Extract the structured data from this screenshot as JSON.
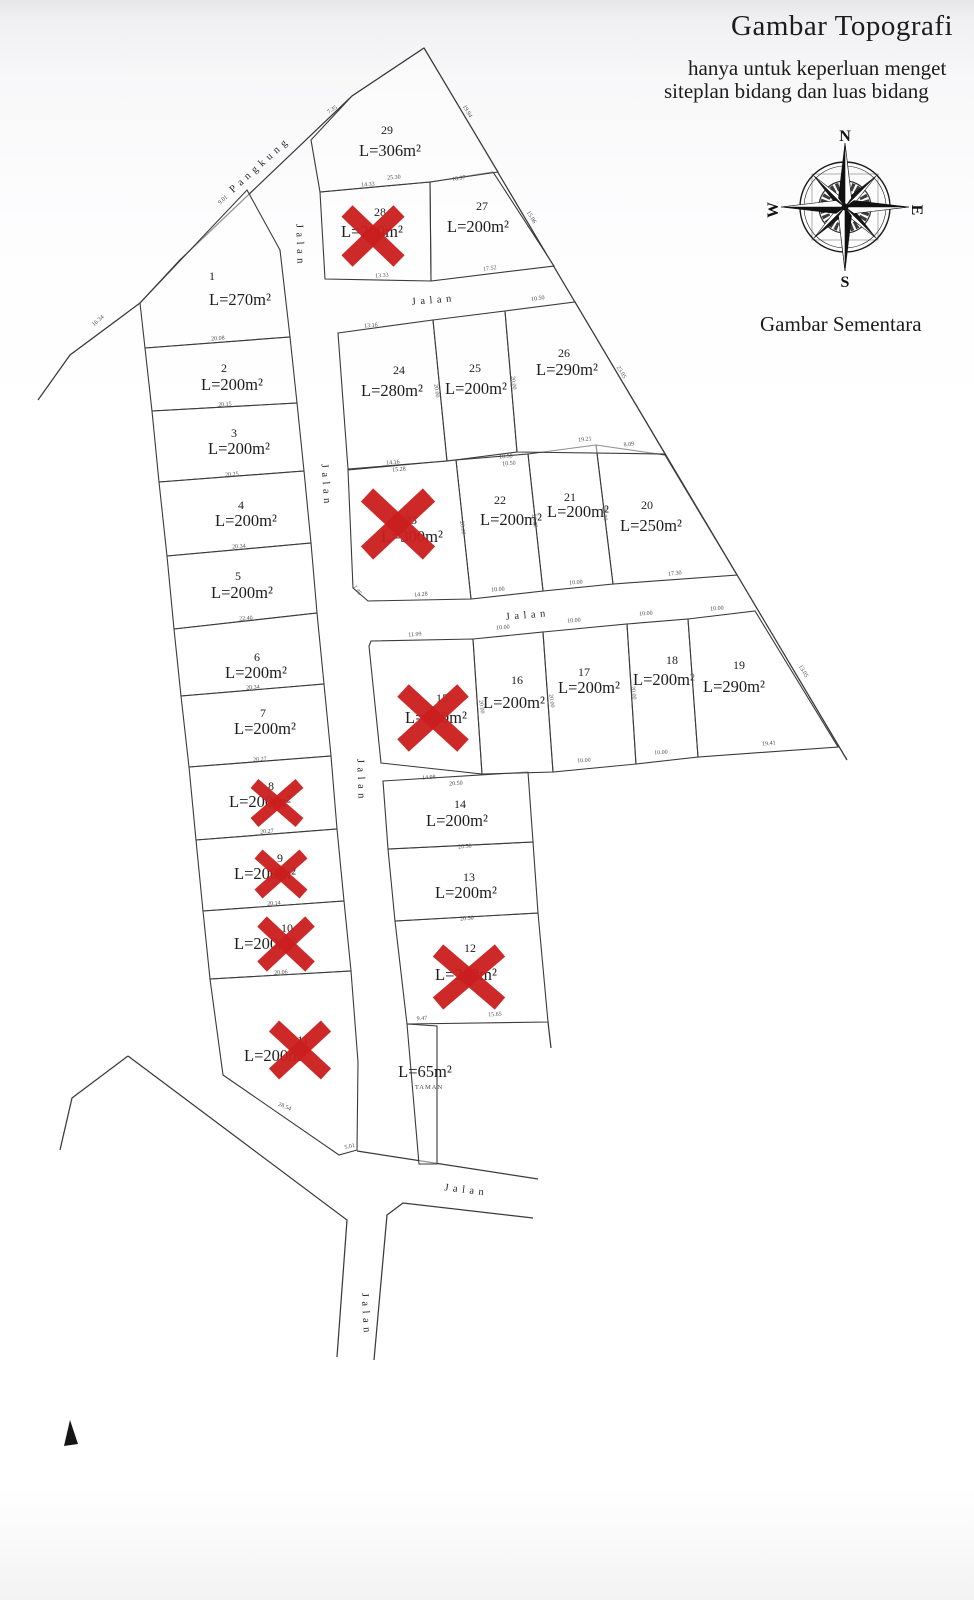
{
  "header": {
    "title": "Gambar Topografi",
    "subtitle_line1": "hanya untuk keperluan menget",
    "subtitle_line2": "siteplan bidang dan luas bidang",
    "note": "Gambar Sementara"
  },
  "compass": {
    "n": "N",
    "e": "E",
    "s": "S",
    "w": "W"
  },
  "colors": {
    "line": "#3a3a3a",
    "text": "#1c1c1c",
    "dim": "#4f4f4f",
    "road": "#272727",
    "x_mark": "#cb1e1e"
  },
  "map": {
    "outlines": [
      {
        "name": "pangkung-boundary",
        "pts": "424,48 352,96 180,260 140,303 70,355 38,400"
      },
      {
        "name": "east-boundary",
        "pts": "424,48 847,760"
      },
      {
        "name": "road-edge-southwest",
        "pts": "128,1056 347,1220 337,1357"
      },
      {
        "name": "road-edge-left-tail",
        "pts": "60,1150 72,1098 128,1056"
      },
      {
        "name": "road-edge-top",
        "pts": "357,1151 538,1179"
      },
      {
        "name": "road-edge-bottom",
        "pts": "533,1218 403,1203 387,1215 374,1360"
      },
      {
        "name": "boundary-tick",
        "pts": "548,1022 551,1048"
      },
      {
        "name": "corner-wedge",
        "pts": "70,1420 78,1444 64,1446",
        "fill": "#151515"
      }
    ],
    "plots": [
      {
        "id": "1",
        "number": "1",
        "area_label": "L=270m²",
        "poly": "247,190 280,250 290,337 145,348 140,303",
        "num": [
          212,
          280
        ],
        "area": [
          240,
          305
        ],
        "sold": false
      },
      {
        "id": "2",
        "number": "2",
        "area_label": "L=200m²",
        "poly": "145,348 290,337 297,403 152,411",
        "num": [
          224,
          372
        ],
        "area": [
          232,
          390
        ],
        "sold": false
      },
      {
        "id": "3",
        "number": "3",
        "area_label": "L=200m²",
        "poly": "152,411 297,403 304,471 159,482",
        "num": [
          234,
          437
        ],
        "area": [
          239,
          454
        ],
        "sold": false
      },
      {
        "id": "4",
        "number": "4",
        "area_label": "L=200m²",
        "poly": "159,482 304,471 311,543 167,556",
        "num": [
          241,
          509
        ],
        "area": [
          246,
          526
        ],
        "sold": false
      },
      {
        "id": "5",
        "number": "5",
        "area_label": "L=200m²",
        "poly": "167,556 311,543 317,613 174,629",
        "num": [
          238,
          580
        ],
        "area": [
          242,
          598
        ],
        "sold": false
      },
      {
        "id": "6",
        "number": "6",
        "area_label": "L=200m²",
        "poly": "174,629 317,613 324,684 181,696",
        "num": [
          257,
          661
        ],
        "area": [
          256,
          678
        ],
        "sold": false
      },
      {
        "id": "7",
        "number": "7",
        "area_label": "L=200m²",
        "poly": "181,696 324,684 331,756 189,767",
        "num": [
          263,
          717
        ],
        "area": [
          265,
          734
        ],
        "sold": false
      },
      {
        "id": "8",
        "number": "8",
        "area_label": "L=200m²",
        "poly": "189,767 331,756 337,829 196,840",
        "num": [
          271,
          790
        ],
        "area": [
          260,
          807
        ],
        "sold": true
      },
      {
        "id": "9",
        "number": "9",
        "area_label": "L=200m²",
        "poly": "196,840 337,829 344,901 203,911",
        "num": [
          280,
          862
        ],
        "area": [
          265,
          879
        ],
        "sold": true
      },
      {
        "id": "10",
        "number": "10",
        "area_label": "L=200m²",
        "poly": "203,911 344,901 351,971 210,979",
        "num": [
          287,
          932
        ],
        "area": [
          265,
          949
        ],
        "sold": true
      },
      {
        "id": "11",
        "number": "11",
        "area_label": "L=200m²",
        "poly": "210,979 351,971 358,1062 357,1150 339,1155 223,1075",
        "num": [
          303,
          1044
        ],
        "area": [
          275,
          1061
        ],
        "sold": true
      },
      {
        "id": "12",
        "number": "12",
        "area_label": "L=200m²",
        "poly": "395,921 538,913 548,1022 407,1024",
        "num": [
          470,
          952
        ],
        "area": [
          466,
          980
        ],
        "sold": true
      },
      {
        "id": "13",
        "number": "13",
        "area_label": "L=200m²",
        "poly": "388,849 533,842 538,913 395,921",
        "num": [
          469,
          881
        ],
        "area": [
          466,
          898
        ],
        "sold": false
      },
      {
        "id": "14",
        "number": "14",
        "area_label": "L=200m²",
        "poly": "383,781 528,772 533,842 388,849",
        "num": [
          460,
          808
        ],
        "area": [
          457,
          826
        ],
        "sold": false
      },
      {
        "id": "15",
        "number": "15",
        "area_label": "L=200m²",
        "poly": "369,646 371,641 473,639 482,774 381,763",
        "num": [
          442,
          702
        ],
        "area": [
          436,
          723
        ],
        "sold": true
      },
      {
        "id": "16",
        "number": "16",
        "area_label": "L=200m²",
        "poly": "473,639 543,632 553,772 482,774",
        "num": [
          517,
          684
        ],
        "area": [
          514,
          708
        ],
        "sold": false
      },
      {
        "id": "17",
        "number": "17",
        "area_label": "L=200m²",
        "poly": "543,632 627,624 636,764 553,772",
        "num": [
          584,
          676
        ],
        "area": [
          589,
          693
        ],
        "sold": false
      },
      {
        "id": "18",
        "number": "18",
        "area_label": "L=200m²",
        "poly": "627,624 688,619 698,757 636,764",
        "num": [
          672,
          664
        ],
        "area": [
          664,
          685
        ],
        "sold": false
      },
      {
        "id": "19",
        "number": "19",
        "area_label": "L=290m²",
        "poly": "688,619 755,611 838,747 698,757",
        "num": [
          739,
          669
        ],
        "area": [
          734,
          692
        ],
        "sold": false
      },
      {
        "id": "20",
        "number": "20",
        "area_label": "L=250m²",
        "poly": "596,445 665,455 737,575 613,584",
        "num": [
          647,
          509
        ],
        "area": [
          651,
          531
        ],
        "sold": false
      },
      {
        "id": "21",
        "number": "21",
        "area_label": "L=200m²",
        "poly": "528,454 596,445 613,584 543,591",
        "num": [
          570,
          501
        ],
        "area": [
          578,
          517
        ],
        "sold": false
      },
      {
        "id": "22",
        "number": "22",
        "area_label": "L=200m²",
        "poly": "456,460 528,454 543,591 471,599",
        "num": [
          500,
          504
        ],
        "area": [
          511,
          525
        ],
        "sold": false
      },
      {
        "id": "23",
        "number": "23",
        "area_label": "L=300m²",
        "poly": "348,470 456,460 471,599 368,601 353,588",
        "num": [
          411,
          524
        ],
        "area": [
          412,
          542
        ],
        "sold": true
      },
      {
        "id": "24",
        "number": "24",
        "area_label": "L=280m²",
        "poly": "338,333 433,320 447,461 348,469",
        "num": [
          399,
          374
        ],
        "area": [
          392,
          396
        ],
        "sold": false
      },
      {
        "id": "25",
        "number": "25",
        "area_label": "L=200m²",
        "poly": "433,320 505,311 517,452 447,461",
        "num": [
          475,
          372
        ],
        "area": [
          476,
          394
        ],
        "sold": false
      },
      {
        "id": "26",
        "number": "26",
        "area_label": "L=290m²",
        "poly": "505,311 575,302 665,454 517,452",
        "num": [
          564,
          357
        ],
        "area": [
          567,
          375
        ],
        "sold": false
      },
      {
        "id": "27",
        "number": "27",
        "area_label": "L=200m²",
        "poly": "430,182 493,172 554,266 431,281",
        "num": [
          482,
          210
        ],
        "area": [
          478,
          232
        ],
        "sold": false
      },
      {
        "id": "28",
        "number": "28",
        "area_label": "L=200m²",
        "poly": "320,192 430,182 431,281 325,279",
        "num": [
          380,
          216
        ],
        "area": [
          372,
          237
        ],
        "sold": true
      },
      {
        "id": "29",
        "number": "29",
        "area_label": "L=306m²",
        "poly": "352,96 424,48 498,172 430,182 320,192 311,140",
        "num": [
          387,
          134
        ],
        "area": [
          390,
          156
        ],
        "sold": false
      },
      {
        "id": "taman",
        "number": "",
        "area_label": "L=65m²",
        "poly": "407,1024 437,1026 437,1164 419,1164",
        "num": [
          0,
          0
        ],
        "area": [
          425,
          1077
        ],
        "sub": "TAMAN",
        "sub_pos": [
          429,
          1089
        ],
        "sold": false
      }
    ],
    "road_labels": [
      {
        "text": "Pangkung",
        "x": 262,
        "y": 167,
        "rot": -42
      },
      {
        "text": "Jalan",
        "x": 297,
        "y": 246,
        "rot": 88
      },
      {
        "text": "Jalan",
        "x": 434,
        "y": 303,
        "rot": -5
      },
      {
        "text": "Jalan",
        "x": 323,
        "y": 486,
        "rot": 86
      },
      {
        "text": "Jalan",
        "x": 528,
        "y": 618,
        "rot": -5
      },
      {
        "text": "Jalan",
        "x": 358,
        "y": 781,
        "rot": 88
      },
      {
        "text": "Jalan",
        "x": 466,
        "y": 1193,
        "rot": 7
      },
      {
        "text": "Jalan",
        "x": 363,
        "y": 1315,
        "rot": 87
      }
    ],
    "dims": [
      {
        "t": "20.08",
        "x": 218,
        "y": 340,
        "r": -4
      },
      {
        "t": "20.15",
        "x": 225,
        "y": 406,
        "r": -4
      },
      {
        "t": "20.25",
        "x": 232,
        "y": 476,
        "r": -4
      },
      {
        "t": "20.34",
        "x": 239,
        "y": 548,
        "r": -4
      },
      {
        "t": "22.40",
        "x": 246,
        "y": 620,
        "r": -4
      },
      {
        "t": "20.34",
        "x": 253,
        "y": 689,
        "r": -4
      },
      {
        "t": "20.27",
        "x": 260,
        "y": 761,
        "r": -4
      },
      {
        "t": "20.27",
        "x": 267,
        "y": 833,
        "r": -4
      },
      {
        "t": "20.14",
        "x": 274,
        "y": 905,
        "r": -4
      },
      {
        "t": "20.06",
        "x": 281,
        "y": 974,
        "r": -4
      },
      {
        "t": "28.54",
        "x": 284,
        "y": 1108,
        "r": 23
      },
      {
        "t": "5.01",
        "x": 350,
        "y": 1148,
        "r": -12
      },
      {
        "t": "9.01",
        "x": 224,
        "y": 201,
        "r": -43
      },
      {
        "t": "16.34",
        "x": 99,
        "y": 322,
        "r": -41
      },
      {
        "t": "7.35",
        "x": 333,
        "y": 111,
        "r": -33
      },
      {
        "t": "19.94",
        "x": 466,
        "y": 112,
        "r": 59
      },
      {
        "t": "15.06",
        "x": 530,
        "y": 218,
        "r": 59
      },
      {
        "t": "23.05",
        "x": 620,
        "y": 373,
        "r": 59
      },
      {
        "t": "13.05",
        "x": 802,
        "y": 672,
        "r": 59
      },
      {
        "t": "14.33",
        "x": 368,
        "y": 186,
        "r": -4
      },
      {
        "t": "25.30",
        "x": 394,
        "y": 179,
        "r": -4
      },
      {
        "t": "10.97",
        "x": 459,
        "y": 180,
        "r": -7
      },
      {
        "t": "13.33",
        "x": 382,
        "y": 277,
        "r": -4
      },
      {
        "t": "17.52",
        "x": 490,
        "y": 270,
        "r": -7
      },
      {
        "t": "13.16",
        "x": 371,
        "y": 327,
        "r": -4
      },
      {
        "t": "10.50",
        "x": 538,
        "y": 300,
        "r": -7
      },
      {
        "t": "14.16",
        "x": 393,
        "y": 464,
        "r": -4
      },
      {
        "t": "15.28",
        "x": 399,
        "y": 471,
        "r": -4
      },
      {
        "t": "10.50",
        "x": 506,
        "y": 458,
        "r": -4
      },
      {
        "t": "10.50",
        "x": 509,
        "y": 465,
        "r": -4
      },
      {
        "t": "19.21",
        "x": 585,
        "y": 441,
        "r": -6
      },
      {
        "t": "8.09",
        "x": 629,
        "y": 446,
        "r": -6
      },
      {
        "t": "1.45",
        "x": 356,
        "y": 591,
        "r": 55
      },
      {
        "t": "14.28",
        "x": 421,
        "y": 596,
        "r": -4
      },
      {
        "t": "10.00",
        "x": 498,
        "y": 591,
        "r": -4
      },
      {
        "t": "10.00",
        "x": 576,
        "y": 584,
        "r": -4
      },
      {
        "t": "17.30",
        "x": 675,
        "y": 575,
        "r": -6
      },
      {
        "t": "11.99",
        "x": 415,
        "y": 636,
        "r": -4
      },
      {
        "t": "10.00",
        "x": 503,
        "y": 629,
        "r": -4
      },
      {
        "t": "10.00",
        "x": 574,
        "y": 622,
        "r": -4
      },
      {
        "t": "10.00",
        "x": 646,
        "y": 615,
        "r": -4
      },
      {
        "t": "10.00",
        "x": 717,
        "y": 610,
        "r": -4
      },
      {
        "t": "10.00",
        "x": 584,
        "y": 762,
        "r": -3
      },
      {
        "t": "10.00",
        "x": 661,
        "y": 754,
        "r": -3
      },
      {
        "t": "19.41",
        "x": 769,
        "y": 745,
        "r": -5
      },
      {
        "t": "14.98",
        "x": 429,
        "y": 779,
        "r": -4
      },
      {
        "t": "20.50",
        "x": 456,
        "y": 785,
        "r": -4
      },
      {
        "t": "20.50",
        "x": 465,
        "y": 848,
        "r": -4
      },
      {
        "t": "20.50",
        "x": 467,
        "y": 920,
        "r": -4
      },
      {
        "t": "9.47",
        "x": 422,
        "y": 1020,
        "r": -3
      },
      {
        "t": "15.65",
        "x": 495,
        "y": 1016,
        "r": -3
      },
      {
        "t": "20.00",
        "x": 461,
        "y": 528,
        "r": 83
      },
      {
        "t": "20.00",
        "x": 533,
        "y": 521,
        "r": 83
      },
      {
        "t": "20.00",
        "x": 603,
        "y": 514,
        "r": 83
      },
      {
        "t": "20.00",
        "x": 480,
        "y": 707,
        "r": 83
      },
      {
        "t": "20.00",
        "x": 550,
        "y": 701,
        "r": 83
      },
      {
        "t": "20.00",
        "x": 632,
        "y": 693,
        "r": 83
      },
      {
        "t": "20.00",
        "x": 435,
        "y": 391,
        "r": 83
      },
      {
        "t": "20.00",
        "x": 512,
        "y": 383,
        "r": 83
      }
    ],
    "x_marks": [
      {
        "x": 373,
        "y": 236,
        "w": 52,
        "h": 50
      },
      {
        "x": 398,
        "y": 524,
        "w": 62,
        "h": 58
      },
      {
        "x": 433,
        "y": 718,
        "w": 60,
        "h": 55
      },
      {
        "x": 277,
        "y": 803,
        "w": 45,
        "h": 39
      },
      {
        "x": 281,
        "y": 874,
        "w": 45,
        "h": 40
      },
      {
        "x": 286,
        "y": 944,
        "w": 48,
        "h": 45
      },
      {
        "x": 300,
        "y": 1050,
        "w": 52,
        "h": 48
      },
      {
        "x": 469,
        "y": 977,
        "w": 62,
        "h": 53
      }
    ]
  }
}
